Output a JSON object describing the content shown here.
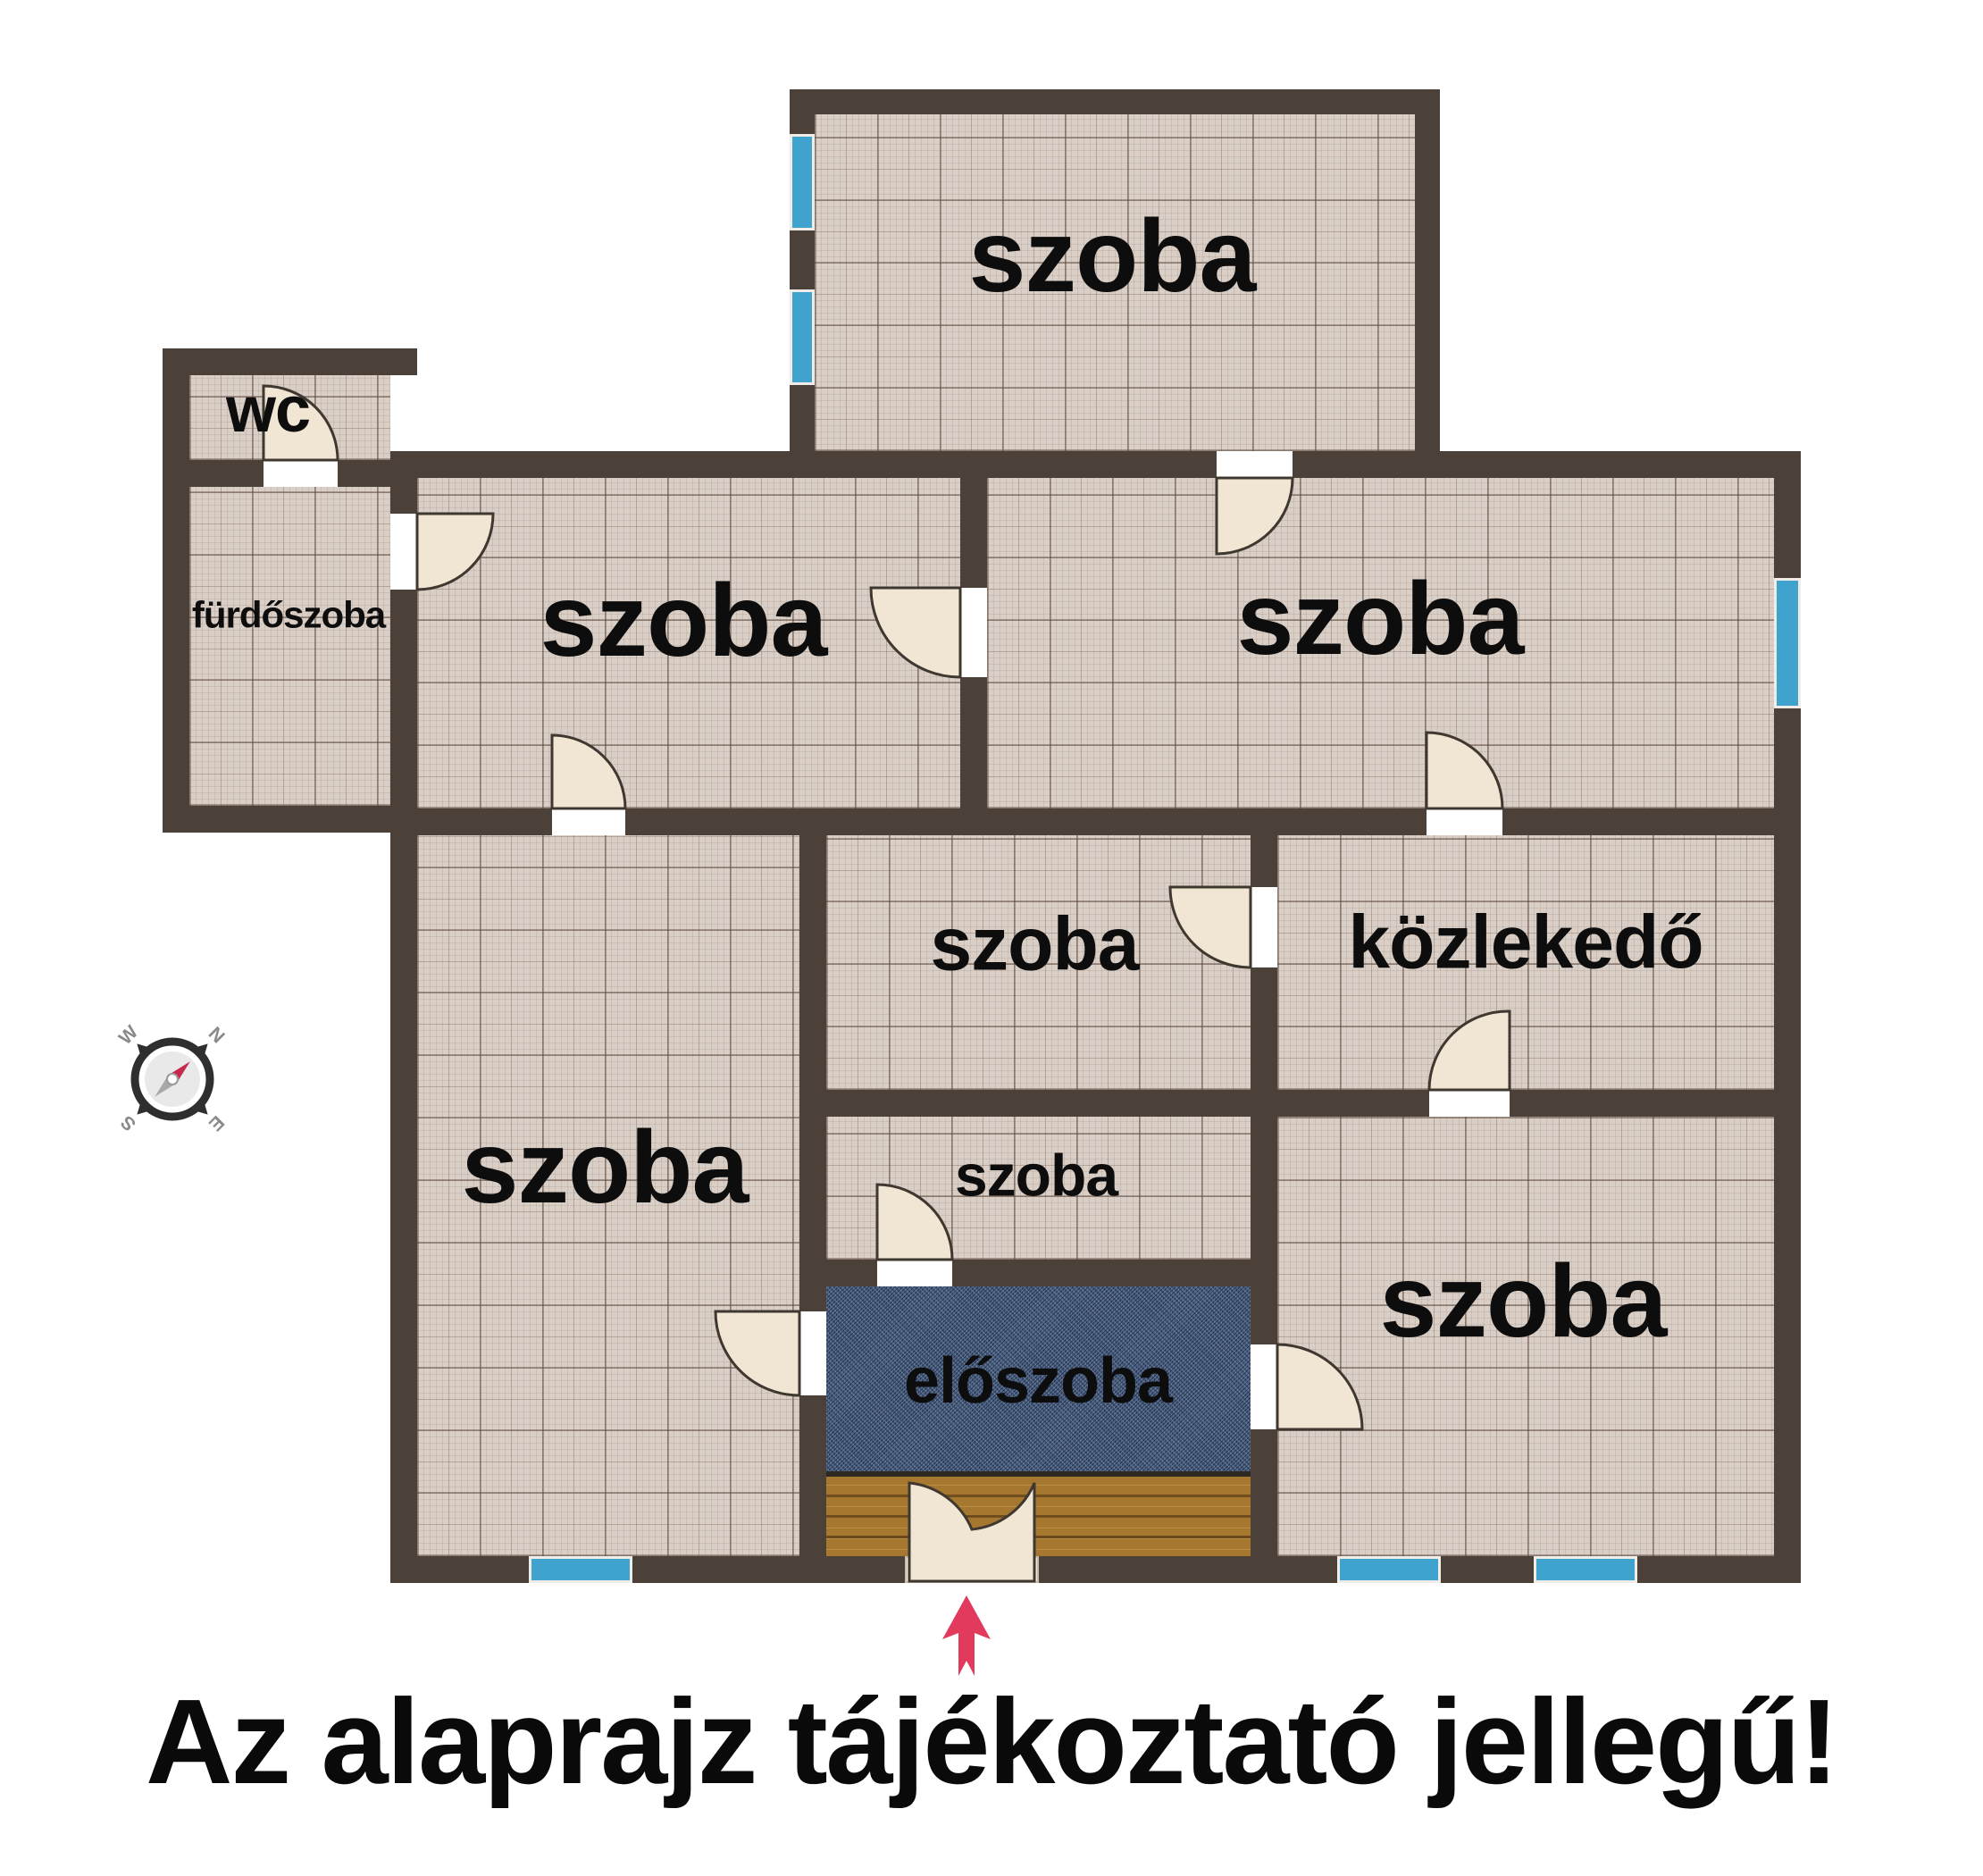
{
  "caption": "Az alaprajz tájékoztató jellegű!",
  "rooms": {
    "top_room": {
      "label": "szoba"
    },
    "wc": {
      "label": "wc"
    },
    "bathroom": {
      "label": "fürdőszoba"
    },
    "room_row2_left": {
      "label": "szoba"
    },
    "room_row2_right": {
      "label": "szoba"
    },
    "room_big": {
      "label": "szoba"
    },
    "room_mid": {
      "label": "szoba"
    },
    "hallway": {
      "label": "közlekedő"
    },
    "room_small": {
      "label": "szoba"
    },
    "entry_hall": {
      "label": "előszoba"
    },
    "room_row4_right": {
      "label": "szoba"
    }
  },
  "compass": {
    "w": "W",
    "n": "N",
    "s": "S",
    "e": "E"
  },
  "colors": {
    "wall": "#4b4138",
    "floor": "#dacfc6",
    "window": "#3fa3cd",
    "door": "#f1e6d4",
    "entry_hall_floor": "#3d5579",
    "wood_floor": "#a5772f",
    "arrow": "#e23a5c",
    "label_text": "#0d0d0d"
  }
}
